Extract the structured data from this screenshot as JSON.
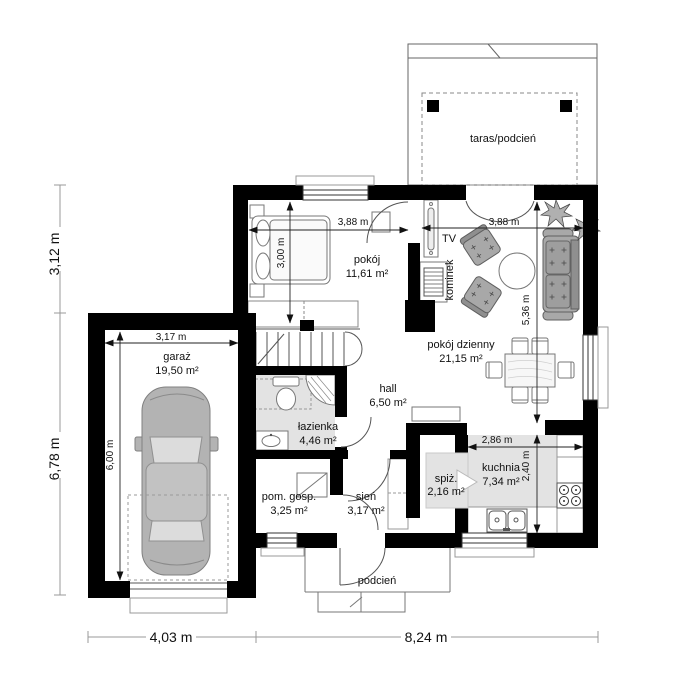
{
  "rooms": {
    "taras": {
      "label": "taras/podcień"
    },
    "pokoj": {
      "name": "pokój",
      "area": "11,61 m²"
    },
    "pokoj_dzienny": {
      "name": "pokój dzienny",
      "area": "21,15 m²"
    },
    "kuchnia": {
      "name": "kuchnia",
      "area": "7,34 m²"
    },
    "spiz": {
      "name": "spiż.",
      "area": "2,16 m²"
    },
    "sien": {
      "name": "sień",
      "area": "3,17 m²"
    },
    "hall": {
      "name": "hall",
      "area": "6,50 m²"
    },
    "lazienka": {
      "name": "łazienka",
      "area": "4,46 m²"
    },
    "pom_gosp": {
      "name": "pom. gosp.",
      "area": "3,25 m²"
    },
    "garaz": {
      "name": "garaż",
      "area": "19,50 m²"
    },
    "podcien": {
      "label": "podcień"
    }
  },
  "features": {
    "tv": "TV",
    "kominek": "kominek"
  },
  "dims": {
    "overall_left_upper": "3,12 m",
    "overall_left_lower": "6,78 m",
    "overall_bottom_left": "4,03 m",
    "overall_bottom_right": "8,24 m",
    "bedroom_w": "3,88 m",
    "bedroom_h": "3,00 m",
    "living_w": "3,88 m",
    "living_h": "5,36 m",
    "garage_w": "3,17 m",
    "garage_h": "6,00 m",
    "kitchen_w": "2,86 m",
    "kitchen_h": "2,40 m"
  },
  "colors": {
    "wall": "#000000",
    "floor_gray": "#e3e3e3",
    "furniture_gray": "#a8a8a8",
    "dim_line": "#222222"
  }
}
